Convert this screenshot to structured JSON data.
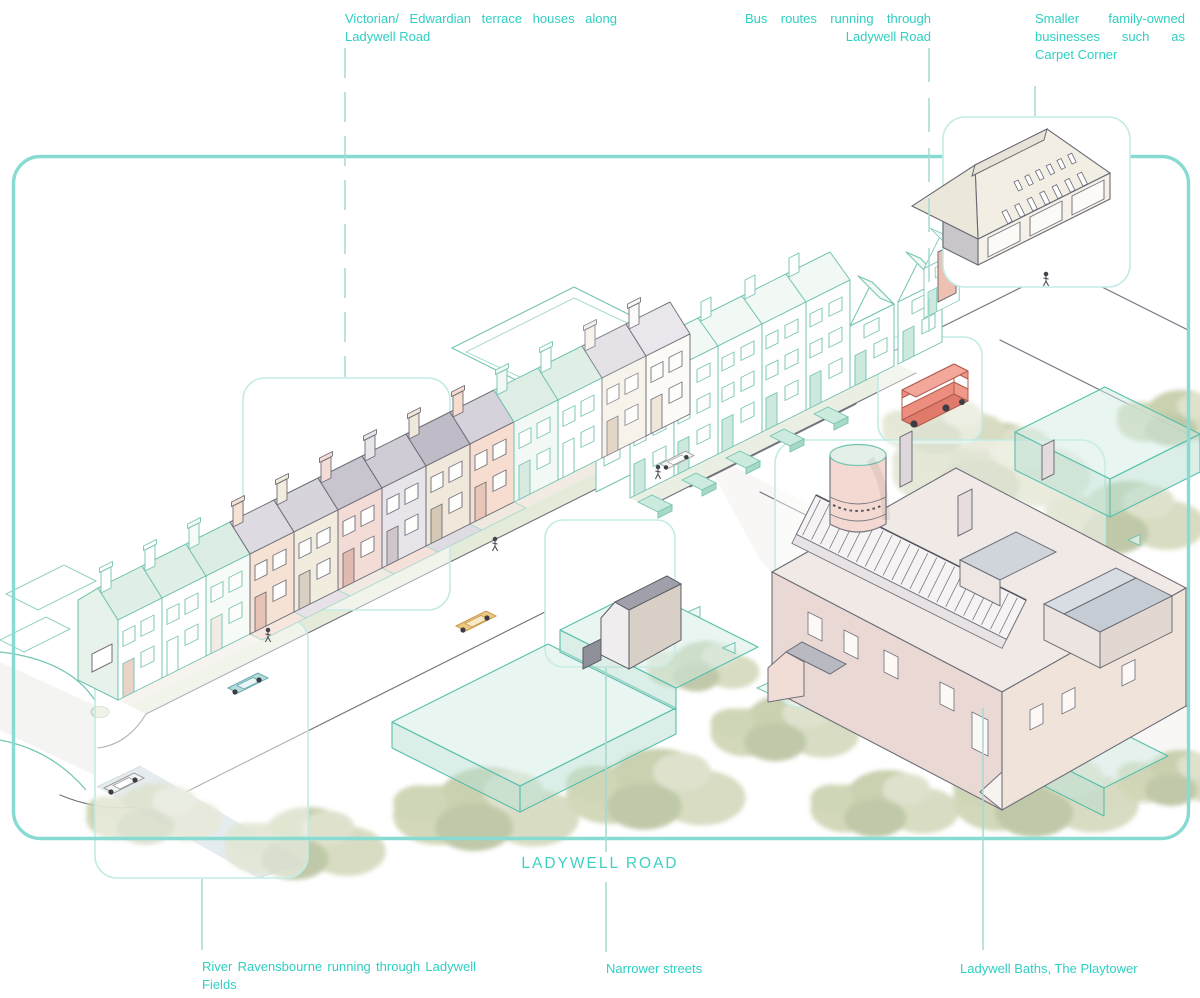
{
  "colors": {
    "accent_teal": "#2fcfc2",
    "frame_border": "#87dbd2",
    "callout_border": "#c3ebe5",
    "bus_red": "#ec8d7e",
    "tree_green": "#c6cea9",
    "river_blue": "#ccd9e2"
  },
  "annotations": {
    "terrace": {
      "text": "Victorian/ Edwardian terrace houses along Ladywell Road"
    },
    "bus": {
      "text": "Bus routes running through Ladywell Road"
    },
    "businesses": {
      "text": "Smaller family-owned businesses such as Carpet Corner"
    },
    "river": {
      "text": "River Ravensbourne running through Ladywell Fields"
    },
    "streets": {
      "text": "Narrower streets"
    },
    "baths": {
      "text": "Ladywell Baths, The Playtower"
    }
  },
  "road_label": "LADYWELL ROAD",
  "scene": {
    "landmarks": [
      "victorian-terrace-row",
      "edwardian-terrace-row",
      "carpet-corner-warehouse",
      "red-bus",
      "ladywell-baths",
      "playtower-water-tower",
      "river-ravensbourne",
      "street-trees",
      "ladywell-road"
    ]
  }
}
